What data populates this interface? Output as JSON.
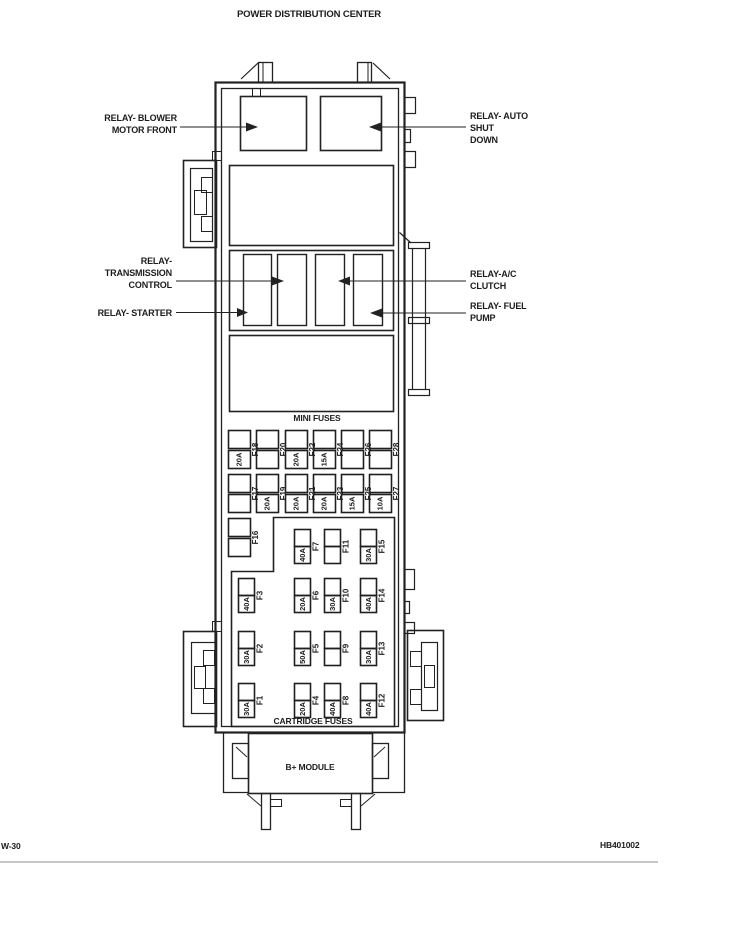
{
  "title": "POWER DISTRIBUTION CENTER",
  "callouts": {
    "blower": {
      "lines": [
        "RELAY- BLOWER",
        "MOTOR FRONT"
      ]
    },
    "auto_shutdown": {
      "lines": [
        "RELAY- AUTO",
        "SHUT",
        "DOWN"
      ]
    },
    "transmission": {
      "lines": [
        "RELAY-",
        "TRANSMISSION",
        "CONTROL"
      ]
    },
    "starter": {
      "lines": [
        "RELAY- STARTER"
      ]
    },
    "ac_clutch": {
      "lines": [
        "RELAY-A/C",
        "CLUTCH"
      ]
    },
    "fuel_pump": {
      "lines": [
        "RELAY- FUEL",
        "PUMP"
      ]
    }
  },
  "section_labels": {
    "mini_fuses": "MINI FUSES",
    "cartridge_fuses": "CARTRIDGE FUSES",
    "b_module": "B+ MODULE"
  },
  "mini_fuses": {
    "row1": [
      {
        "id": "F18",
        "amp": "20A"
      },
      {
        "id": "F20",
        "amp": ""
      },
      {
        "id": "F22",
        "amp": "20A"
      },
      {
        "id": "F24",
        "amp": "15A"
      },
      {
        "id": "F26",
        "amp": ""
      },
      {
        "id": "F28",
        "amp": ""
      }
    ],
    "row2": [
      {
        "id": "F17",
        "amp": ""
      },
      {
        "id": "F19",
        "amp": "20A"
      },
      {
        "id": "F21",
        "amp": "20A"
      },
      {
        "id": "F23",
        "amp": "20A"
      },
      {
        "id": "F25",
        "amp": "15A"
      },
      {
        "id": "F27",
        "amp": "10A"
      }
    ],
    "single": {
      "id": "F16",
      "amp": ""
    }
  },
  "cartridge_fuses": {
    "row1": [
      {
        "id": "F7",
        "amp": "40A"
      },
      {
        "id": "F11",
        "amp": ""
      },
      {
        "id": "F15",
        "amp": "30A"
      }
    ],
    "row2": [
      {
        "id": "F3",
        "amp": "40A"
      },
      {
        "id": "F6",
        "amp": "20A"
      },
      {
        "id": "F10",
        "amp": "30A"
      },
      {
        "id": "F14",
        "amp": "40A"
      }
    ],
    "row3": [
      {
        "id": "F2",
        "amp": "30A"
      },
      {
        "id": "F5",
        "amp": "50A"
      },
      {
        "id": "F9",
        "amp": ""
      },
      {
        "id": "F13",
        "amp": "30A"
      }
    ],
    "row4": [
      {
        "id": "F1",
        "amp": "30A"
      },
      {
        "id": "F4",
        "amp": "20A"
      },
      {
        "id": "F8",
        "amp": "40A"
      },
      {
        "id": "F12",
        "amp": "40A"
      }
    ]
  },
  "footer": {
    "left": "W-30",
    "right": "HB401002"
  },
  "colors": {
    "line": "#1f1f1f",
    "text": "#1c1c1c",
    "rule": "#b3b3b3"
  }
}
